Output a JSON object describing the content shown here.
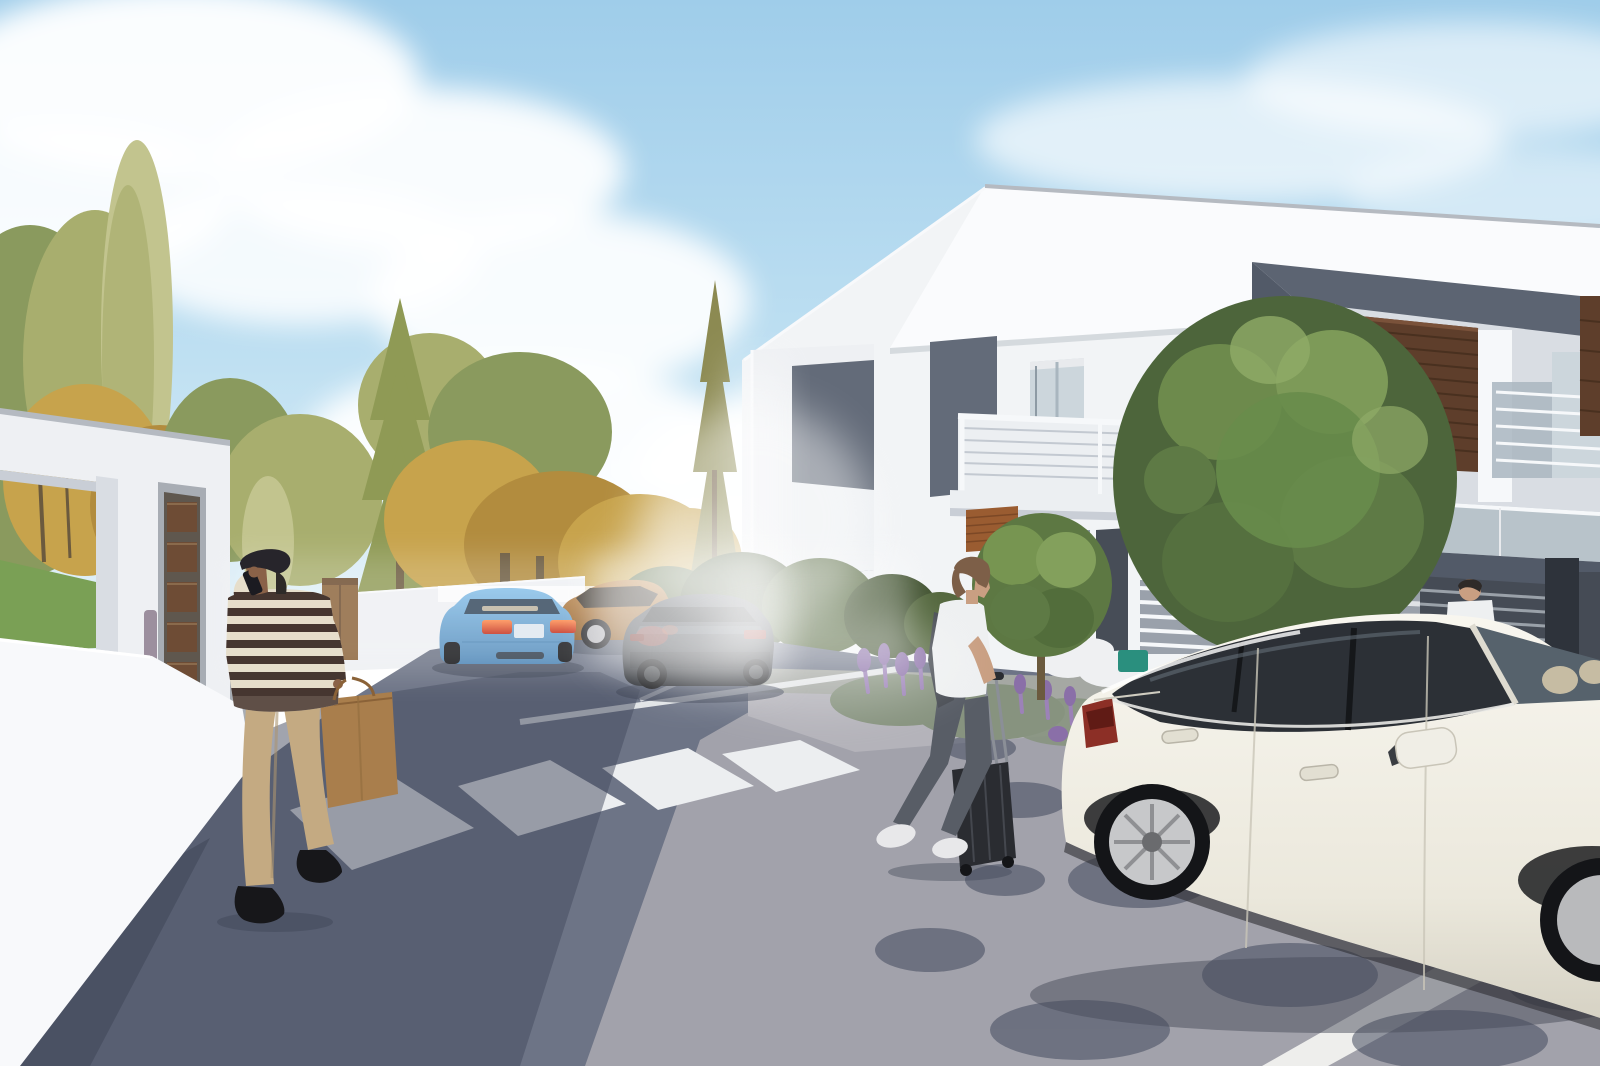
{
  "meta": {
    "title": "Residential street architectural rendering",
    "description": "3D exterior visualization of a modern white two-story duplex development on a sunny day: asphalt street with zebra crosswalk, entrance gate with mailbox panel, blue sedan driving away, bronze and dark gray sedans parked, white luxury sedan in the foreground, a man talking on the phone carrying a brown shopping bag, a woman pulling a black rolling suitcase, ornamental round trees, lavender flower beds, background of green and golden trees under a partly cloudy blue sky"
  },
  "scene_objects": [
    "partly-cloudy-sky",
    "background-trees",
    "green-lawn",
    "entrance-gate-structure",
    "mailbox-panel",
    "intercom-strip",
    "white-boundary-wall",
    "wooden-cabinet",
    "modern-duplex-house",
    "balcony-railing",
    "privacy-screen-brown",
    "glass-balustrade",
    "roller-shutter",
    "entry-door",
    "white-bar-fence",
    "dark-slat-gate",
    "ornamental-tree-large",
    "ornamental-tree-small",
    "lavender-flower-bed",
    "garden-shrubs",
    "white-cushions",
    "teal-box",
    "asphalt-street",
    "sidewalk",
    "zebra-crosswalk",
    "parking-lines",
    "blue-sedan",
    "bronze-sedan",
    "dark-gray-sedan",
    "white-sedan-foreground",
    "man-on-phone-with-shopping-bag",
    "woman-with-rolling-suitcase",
    "resident-behind-car",
    "tree-shadows-on-road"
  ],
  "colors": {
    "sky_top": "#9fcdea",
    "sky_mid": "#bfe0f2",
    "sky_low": "#e8f3f9",
    "cloud": "#ffffff",
    "tree_green": "#8a9a5e",
    "tree_green_dark": "#5e7242",
    "tree_olive": "#a8ae6e",
    "tree_pale": "#c2c48e",
    "tree_gold": "#c7a34c",
    "tree_gold_dark": "#b28c3e",
    "conifer": "#8f9a55",
    "conifer_dry": "#8c8a52",
    "trunk": "#6b5a3e",
    "lawn": "#7aa055",
    "wall_white": "#eef0f3",
    "wall_bright": "#f8f9fb",
    "wall_shade": "#d9dde3",
    "beam_cap": "#b5bac1",
    "under_shadow": "#c9ced6",
    "mailbox_frame": "#a8adb4",
    "mailbox_dark": "#5f574e",
    "mailbox_slot": "#6e4c35",
    "mailbox_slot_hi": "#8a6a4c",
    "intercom": "#9c8f9e",
    "facade": "#f2f4f6",
    "fascia": "#fafbfd",
    "fascia_edge": "#d5dade",
    "slate": "#5c6472",
    "slate_dark": "#525a68",
    "slate_soffit": "#454c58",
    "panel_slate": "#636b79",
    "screen_brown": "#5e3e2b",
    "screen_slat": "#49301f",
    "screen_edge": "#7a523a",
    "shutter_rust": "#9a5c31",
    "shutter_slat": "#7c4826",
    "glass": "#ccd6dc",
    "glass_mid": "#a9b6bf",
    "glass_frame": "#e8eaed",
    "glass_dark": "#8d9aa4",
    "railing": "#f6f8fa",
    "cable": "#c3c9d1",
    "slab": "#eceff2",
    "door_dark": "#474d57",
    "fence_white": "#dfe2e6",
    "fence_bar_bg": "#9aa1ab",
    "fence_dark": "#454b55",
    "fence_slat": "#9aa1a9",
    "fence_pillar": "#2e333b",
    "road": "#6d7486",
    "road_sun": "#a5a4ad",
    "road_mid": "#8b8f9a",
    "road_shadow": "#434a5e",
    "road_deep": "#3a4153",
    "sidewalk": "#b4b3ba",
    "soil": "#a5a8a3",
    "crosswalk": "#eceef0",
    "line_white": "#e8eaec",
    "blue_car": "#6fb0de",
    "blue_car_dark": "#4e86b6",
    "blue_glass": "#31465a",
    "parcel_shelf": "#cbbfa6",
    "taillight": "#ff6a3a",
    "taillight_deep": "#c22a18",
    "plate": "#dfe7f0",
    "bronze_car": "#b27a42",
    "bronze_dark": "#8a571f",
    "bronze_glass": "#352e26",
    "dark_car": "#303439",
    "dark_car_hi": "#555b66",
    "dark_glass": "#1f2227",
    "dark_tail": "#8c2b22",
    "red_reflection": "#a03a30",
    "white_car": "#efede4",
    "white_car_shade": "#d2cec0",
    "white_car_glass": "#2c3036",
    "windshield": "#56626c",
    "seat_beige": "#d3c6aa",
    "chrome": "#c7c8ca",
    "tire": "#141518",
    "rim_dark": "#3f4246",
    "tail_red": "#8c2f26",
    "skin_man": "#8a6248",
    "skin_woman": "#c99f82",
    "cap": "#27252b",
    "hair_dark": "#2e2a28",
    "sweater": "#e6decb",
    "stripe": "#463630",
    "pants": "#c4aa82",
    "shoe": "#17171a",
    "bag": "#a97e4c",
    "bag_dark": "#8a6238",
    "hair_brown": "#7d5f48",
    "tee": "#eef0f1",
    "jeans": "#585d66",
    "sneaker": "#e8e8ea",
    "suitcase": "#2a2c31",
    "suitcase_hi": "#44474e",
    "jacket": "#4a4e55",
    "rod": "#8b8f97",
    "shrub": "#55683f",
    "shrub_dark": "#435432",
    "lavender": "#9c82b8",
    "lavender_deep": "#8a6fa8",
    "lavender_leaf": "#87937f",
    "cushion": "#eff0f2",
    "teal_box": "#2a8f7e",
    "shadow": "#3e4556"
  }
}
